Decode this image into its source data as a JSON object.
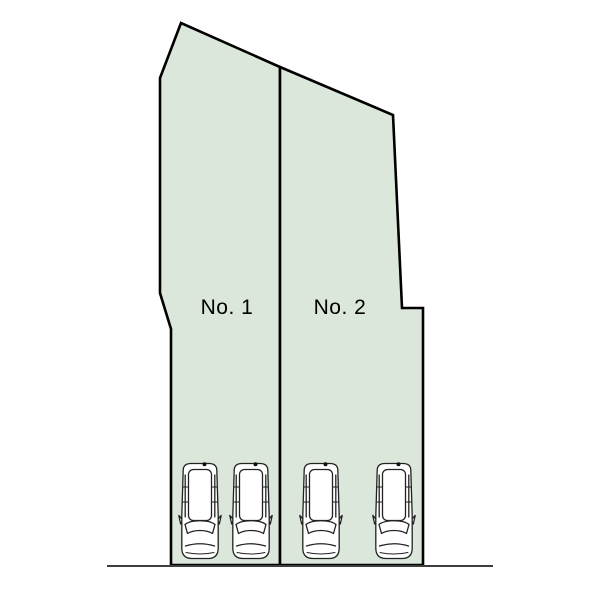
{
  "diagram": {
    "type": "parking-plot-layout",
    "plots": [
      {
        "label": "No. 1",
        "cars": 2
      },
      {
        "label": "No. 2",
        "cars": 2
      }
    ],
    "car_count": 4,
    "colors": {
      "plot_fill": "#dae7da",
      "plot_outline": "#000000",
      "road_line": "#3d3d3d",
      "label_text": "#000000",
      "car_fill": "#ffffff",
      "car_outline": "#222222",
      "background": "#ffffff"
    }
  }
}
